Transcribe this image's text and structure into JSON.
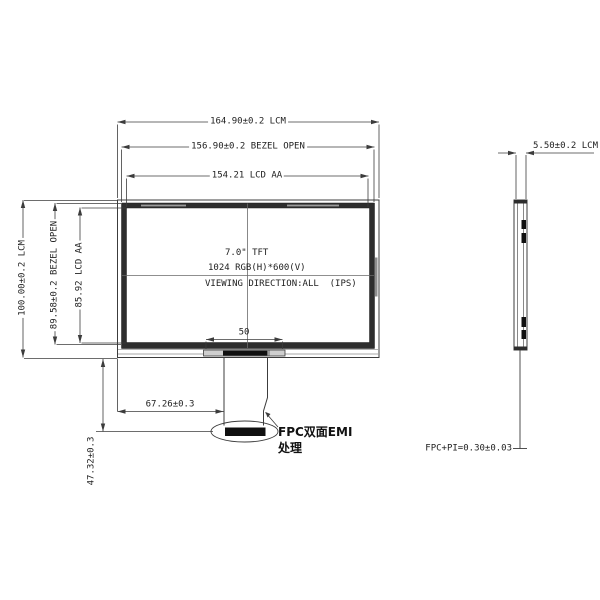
{
  "front_view": {
    "spec": {
      "size": "7.0\" TFT",
      "resolution": "1024 RGB(H)*600(V)",
      "viewing": "VIEWING DIRECTION:ALL  (IPS)"
    },
    "dims": {
      "width_lcm": "164.90±0.2 LCM",
      "width_bezel_open": "156.90±0.2 BEZEL OPEN",
      "width_lcd_aa": "154.21 LCD AA",
      "height_lcm": "100.00±0.2 LCM",
      "height_bezel_open": "89.58±0.2 BEZEL OPEN",
      "height_lcd_aa": "85.92 LCD AA",
      "fpc_connector_width": "50",
      "fpc_offset": "67.26±0.3",
      "fpc_drop_length": "47.32±0.3"
    },
    "fpc_note": {
      "line1": "FPC双面EMI",
      "line2": "处理"
    }
  },
  "side_view": {
    "dims": {
      "thickness": "5.50±0.2 LCM",
      "fpc_thickness": "FPC+PI=0.30±0.03"
    }
  },
  "colors": {
    "line": "#3c3c3c",
    "bezel_fill": "#2e2e2e",
    "pad_fill": "#101010"
  }
}
